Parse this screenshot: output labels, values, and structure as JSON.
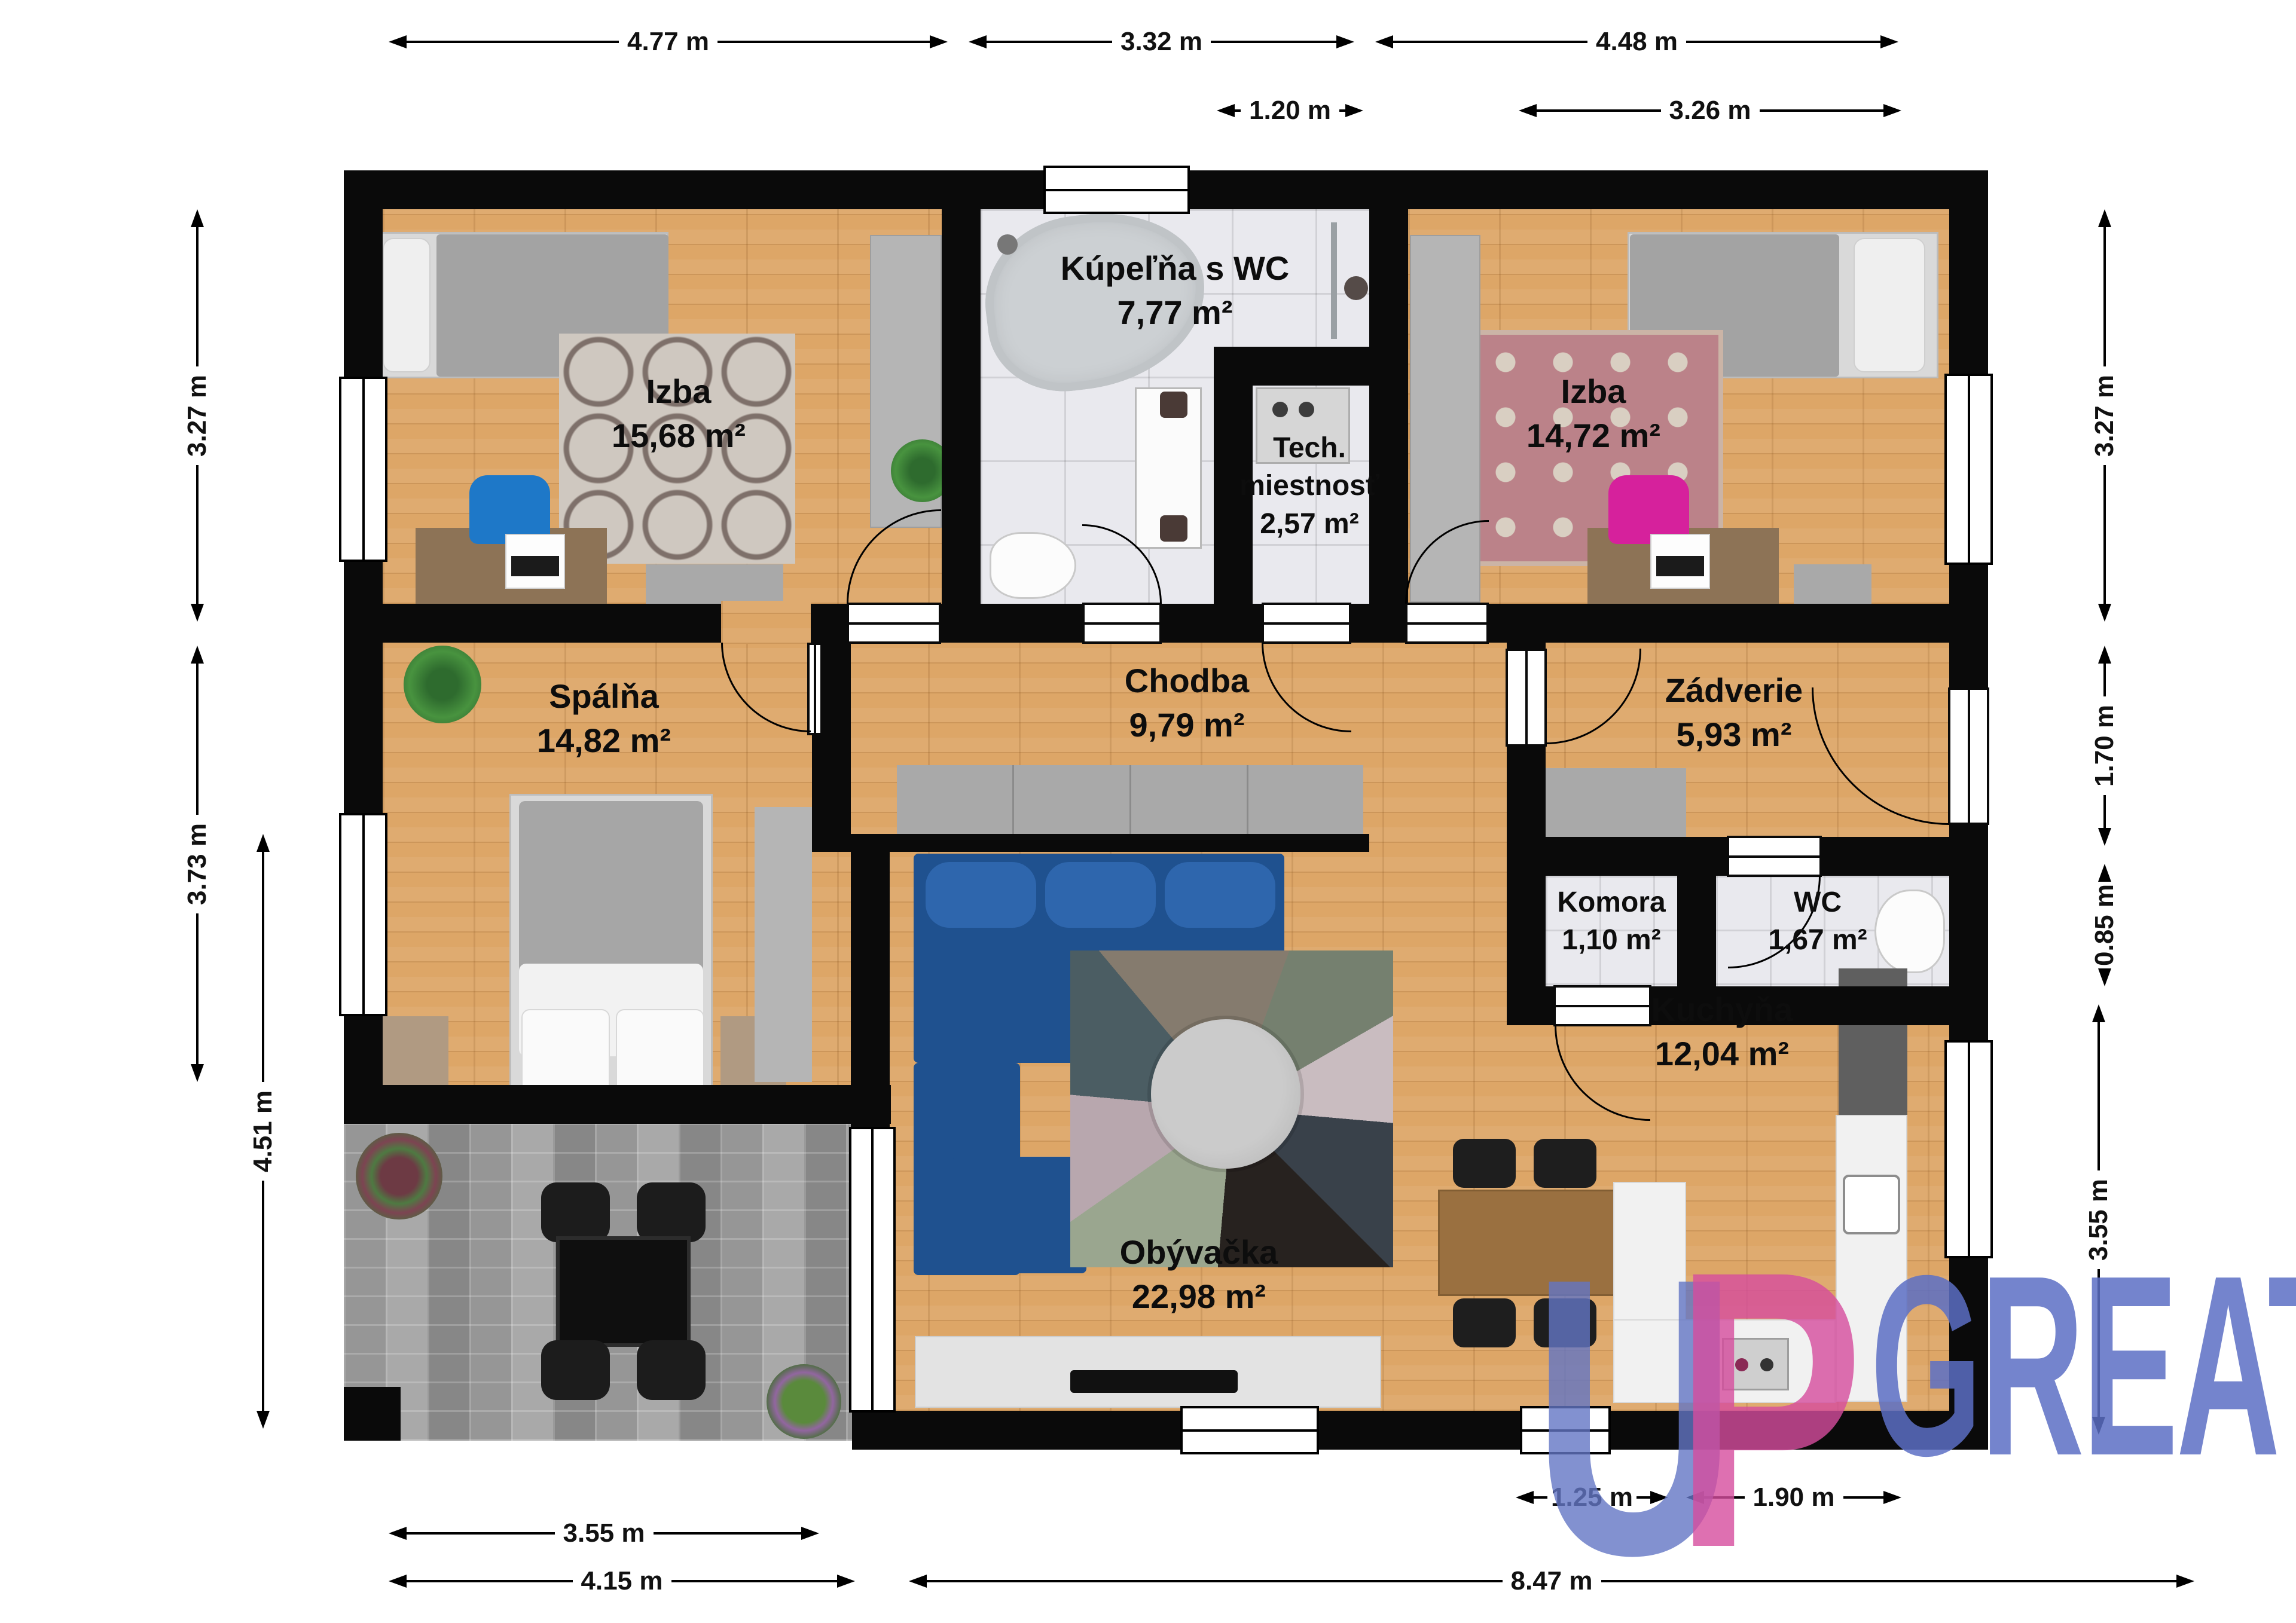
{
  "rooms": {
    "izba1": {
      "name": "Izba",
      "area": "15,68 m²"
    },
    "kupelna": {
      "name": "Kúpeľňa s WC",
      "area": "7,77 m²"
    },
    "tech": {
      "name1": "Tech.",
      "name2": "miestnosť",
      "area": "2,57 m²"
    },
    "izba2": {
      "name": "Izba",
      "area": "14,72 m²"
    },
    "spalna": {
      "name": "Spálňa",
      "area": "14,82 m²"
    },
    "chodba": {
      "name": "Chodba",
      "area": "9,79 m²"
    },
    "zadverie": {
      "name": "Zádverie",
      "area": "5,93 m²"
    },
    "komora": {
      "name": "Komora",
      "area": "1,10 m²"
    },
    "wc": {
      "name": "WC",
      "area": "1,67 m²"
    },
    "kuchyna": {
      "name": "Kuchyňa",
      "area": "12,04 m²"
    },
    "obyvacka": {
      "name": "Obývačka",
      "area": "22,98 m²"
    }
  },
  "dims": {
    "top1": "4.77 m",
    "top2": "3.32 m",
    "top3": "4.48 m",
    "sub1": "1.20 m",
    "sub2": "3.26 m",
    "left1": "3.27 m",
    "left2": "3.73 m",
    "left3": "4.51 m",
    "right1": "3.27 m",
    "right2": "1.70 m",
    "right3": "0.85 m",
    "right4": "3.55 m",
    "bottom1": "1.25 m",
    "bottom2": "1.90 m",
    "bottom3": "3.55 m",
    "bottom4": "4.15 m",
    "bottom5": "8.47 m"
  },
  "logo": {
    "u": "U",
    "p": "P",
    "great": "GREAT",
    "blue": "rgba(99,117,196,0.8)",
    "pink": "rgba(214,76,158,0.8)"
  },
  "colors": {
    "wall": "#0a0a0a",
    "wood": "#dda667",
    "tile": "#e9e9ee",
    "pavement": "#9c9c9c",
    "sofa_blue": "#1f518f",
    "chair_blue": "#1e78c8",
    "chair_pink": "#d6219c"
  }
}
